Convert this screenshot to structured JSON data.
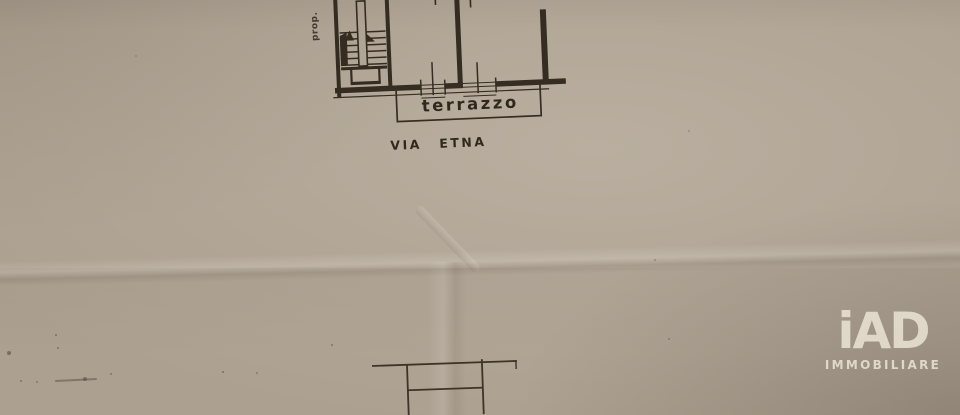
{
  "plan": {
    "labels": {
      "terrace": "terrazzo",
      "street_prefix": "VIA",
      "street_name": "ETNA",
      "property_abbrev": "prop."
    }
  },
  "watermark": {
    "brand": "iAD",
    "subtitle": "IMMOBILIARE"
  },
  "colors": {
    "paper": "#aca090",
    "ink": "#2b2218",
    "watermark": "#ece5d6"
  }
}
